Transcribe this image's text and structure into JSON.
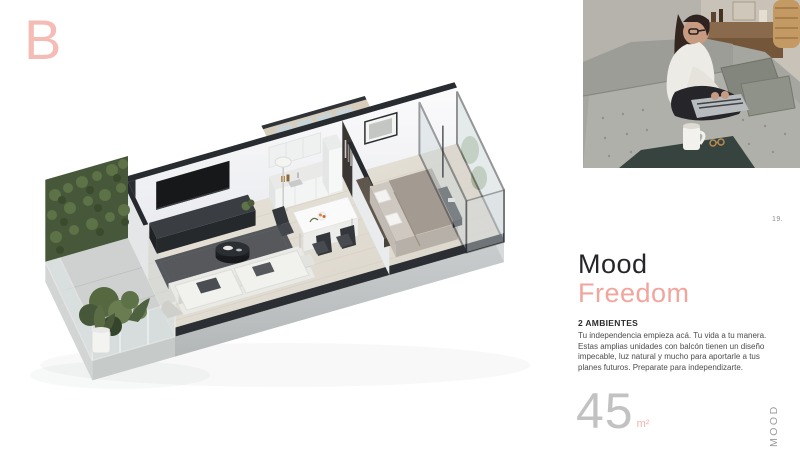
{
  "page": {
    "section_letter": "B",
    "page_number": "19.",
    "sidebar_vertical_label": "MOOD"
  },
  "heading": {
    "title": "Mood",
    "subtitle": "Freedom"
  },
  "details": {
    "unit_type": "2 AMBIENTES",
    "description_lines": [
      "Tu independencia empieza acá.  Tu vida a tu manera.",
      "Estas amplias unidades con balcón tienen un diseño",
      "impecable, luz natural y mucho para aportarle a tus",
      "planes futuros. Preparate para independizarte."
    ],
    "area_value": "45",
    "area_unit": "m²"
  },
  "media": {
    "floorplan_label": "isometric-apartment-floorplan",
    "photo_label": "woman-working-on-laptop-on-gray-sofa"
  },
  "colors": {
    "accent": "#f2a59d",
    "accent_light": "#f5bcb5",
    "title_dark": "#26262a",
    "body_text": "#4c4c4c",
    "muted_gray": "#c2c2c2"
  }
}
